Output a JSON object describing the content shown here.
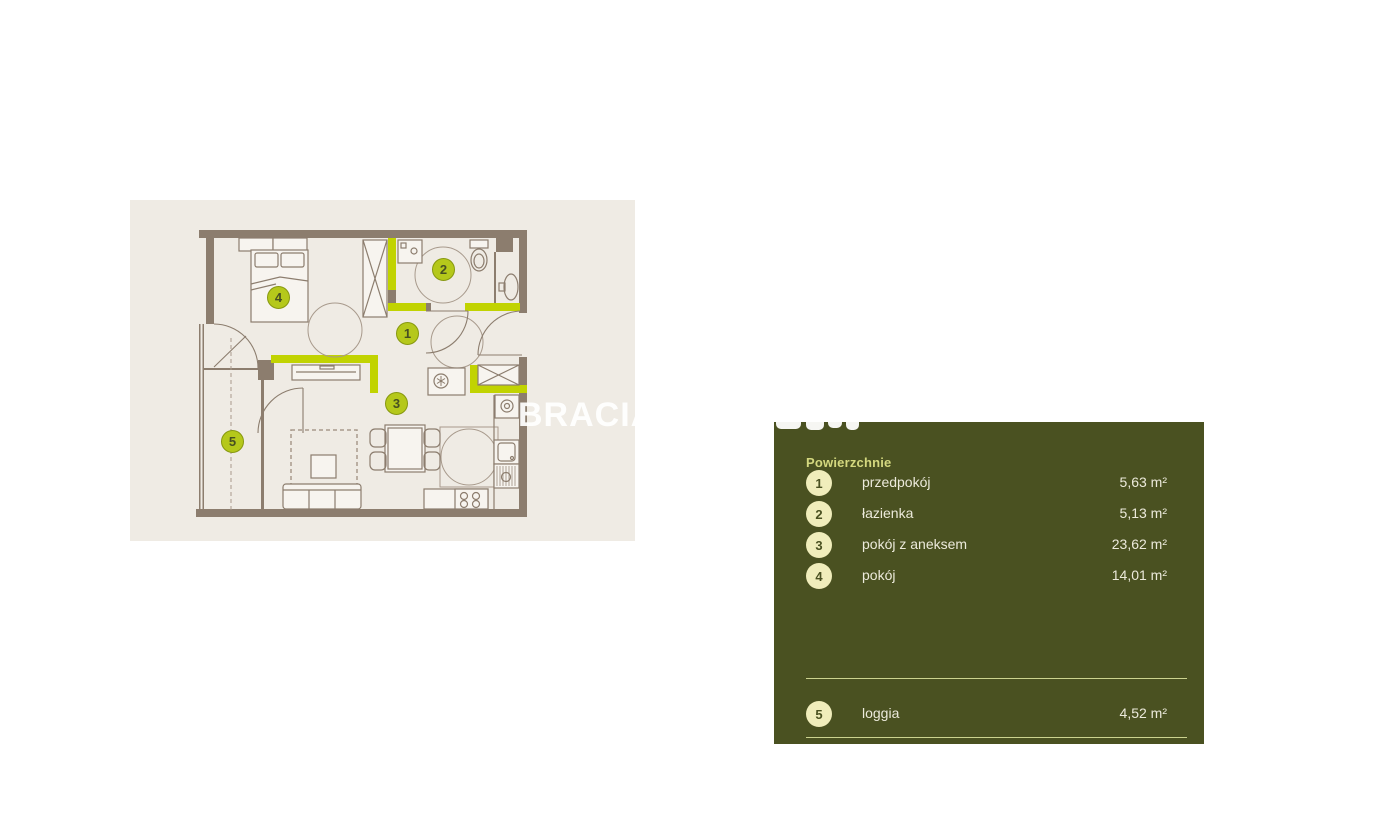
{
  "plan": {
    "watermark": "BRACIA",
    "markers": [
      {
        "label": "1"
      },
      {
        "label": "2"
      },
      {
        "label": "3"
      },
      {
        "label": "4"
      },
      {
        "label": "5"
      }
    ]
  },
  "legend": {
    "title": "Powierzchnie",
    "rows": [
      {
        "num": "1",
        "label": "przedpokój",
        "value": "5,63 m²"
      },
      {
        "num": "2",
        "label": "łazienka",
        "value": "5,13 m²"
      },
      {
        "num": "3",
        "label": "pokój z aneksem",
        "value": "23,62 m²"
      },
      {
        "num": "4",
        "label": "pokój",
        "value": "14,01 m²"
      },
      {
        "num": "5",
        "label": "loggia",
        "value": "4,52 m²"
      }
    ]
  },
  "colors": {
    "panel_background": "#4a5121",
    "plan_background": "#efebe4",
    "wall": "#8c7d6e",
    "accent_lime": "#c1d301",
    "badge_fill": "#f0edbb",
    "arrow": "#454d22"
  }
}
